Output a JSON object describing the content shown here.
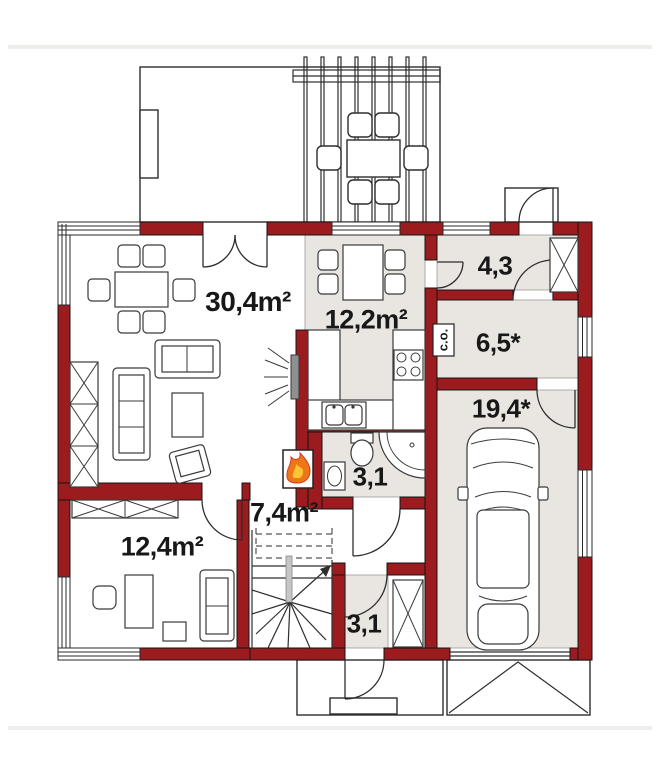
{
  "plan": {
    "colors": {
      "wall": "#9b1b1f",
      "floor": "#e9e6e1",
      "line": "#2e2e2e",
      "flame_orange": "#ef7519",
      "flame_red": "#d43c1c",
      "flame_yellow": "#fdc433",
      "rail_gray": "#c6c6c6"
    },
    "rooms": [
      {
        "name": "living-room",
        "label": "30,4m²"
      },
      {
        "name": "kitchen",
        "label": "12,2m²"
      },
      {
        "name": "entrance-hall",
        "label": "4,3"
      },
      {
        "name": "boiler-room",
        "label": "6,5*"
      },
      {
        "name": "garage",
        "label": "19,4*"
      },
      {
        "name": "bathroom",
        "label": "3,1"
      },
      {
        "name": "hall",
        "label": "7,4m²"
      },
      {
        "name": "bedroom",
        "label": "12,4m²"
      },
      {
        "name": "vestibule",
        "label": "3,1"
      }
    ],
    "boiler_unit_label": "c.o."
  }
}
